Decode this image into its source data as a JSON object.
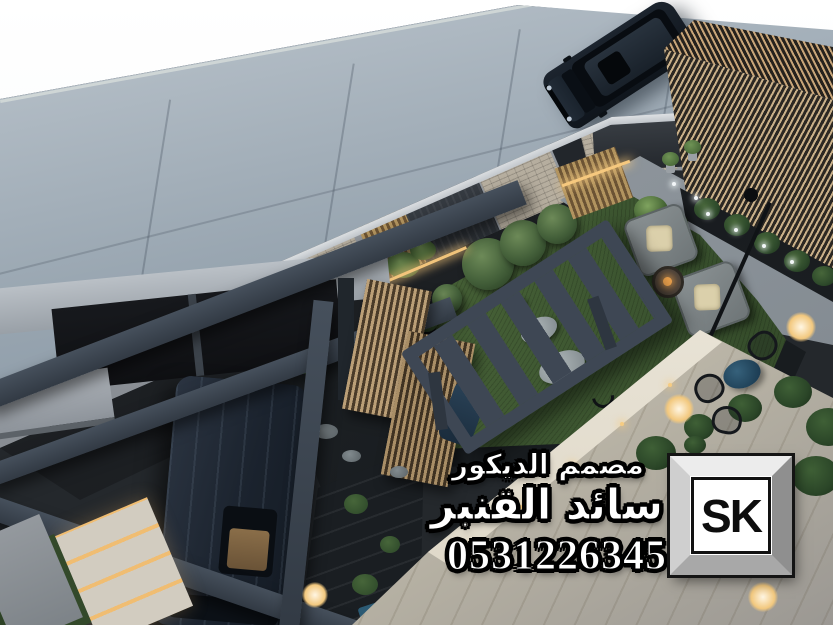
{
  "image": {
    "kind": "3d-architectural-render",
    "description": "Aerial dusk render of a modern villa landscape: street with parked dark SUV, mixed stone and wood boundary wall, green lawn with two gray lounge chairs and fire bowl, slatted steel pergola with wooden screens, carport with second dark car, illuminated steps, and a lit patio deck with a blue bistro table"
  },
  "overlay": {
    "profession": "مصمم الديكور",
    "designer_name": "سائد القنبر",
    "phone": "0531226345",
    "logo": "SK",
    "text_color": "#ffffff",
    "outline_color": "#000000",
    "badge": {
      "frame_light": "#ececec",
      "frame_dark": "#8f8f8f",
      "inner_bg": "#ffffff",
      "letter_color": "#0d0d0d"
    }
  },
  "scene": {
    "elements": [
      "sky",
      "street",
      "suv",
      "boundary-wall",
      "wood-slat-fence",
      "corner-pergola-roof",
      "walkway",
      "garden-lawn",
      "topiary-bushes",
      "stepping-stones",
      "lounge-chairs",
      "fire-bowl",
      "path-lights",
      "pergola-ladder",
      "wood-screens",
      "carport-beams",
      "carport-roof-panels",
      "carport-car",
      "lit-steps",
      "pebble-path",
      "boardwalk",
      "patio-deck",
      "deck-band",
      "bistro-set",
      "planter-row",
      "potted-plants",
      "lamps"
    ],
    "palette": {
      "sky": "#f4f7f9",
      "street": "#8d9aa6",
      "wall_concrete": "#8d9298",
      "wall_light_stone": "#b6ae9f",
      "wall_dark_stone": "#2e3338",
      "wood_slat": "#b2945f",
      "lawn": "#3c5530",
      "pergola_steel": "#3e4754",
      "cushion": "#dbd0ab",
      "patio": "#d6cfbf",
      "bistro_table_blue": "#22455c",
      "warm_light": "#f6c87e",
      "car_dark": "#1b232e"
    }
  }
}
